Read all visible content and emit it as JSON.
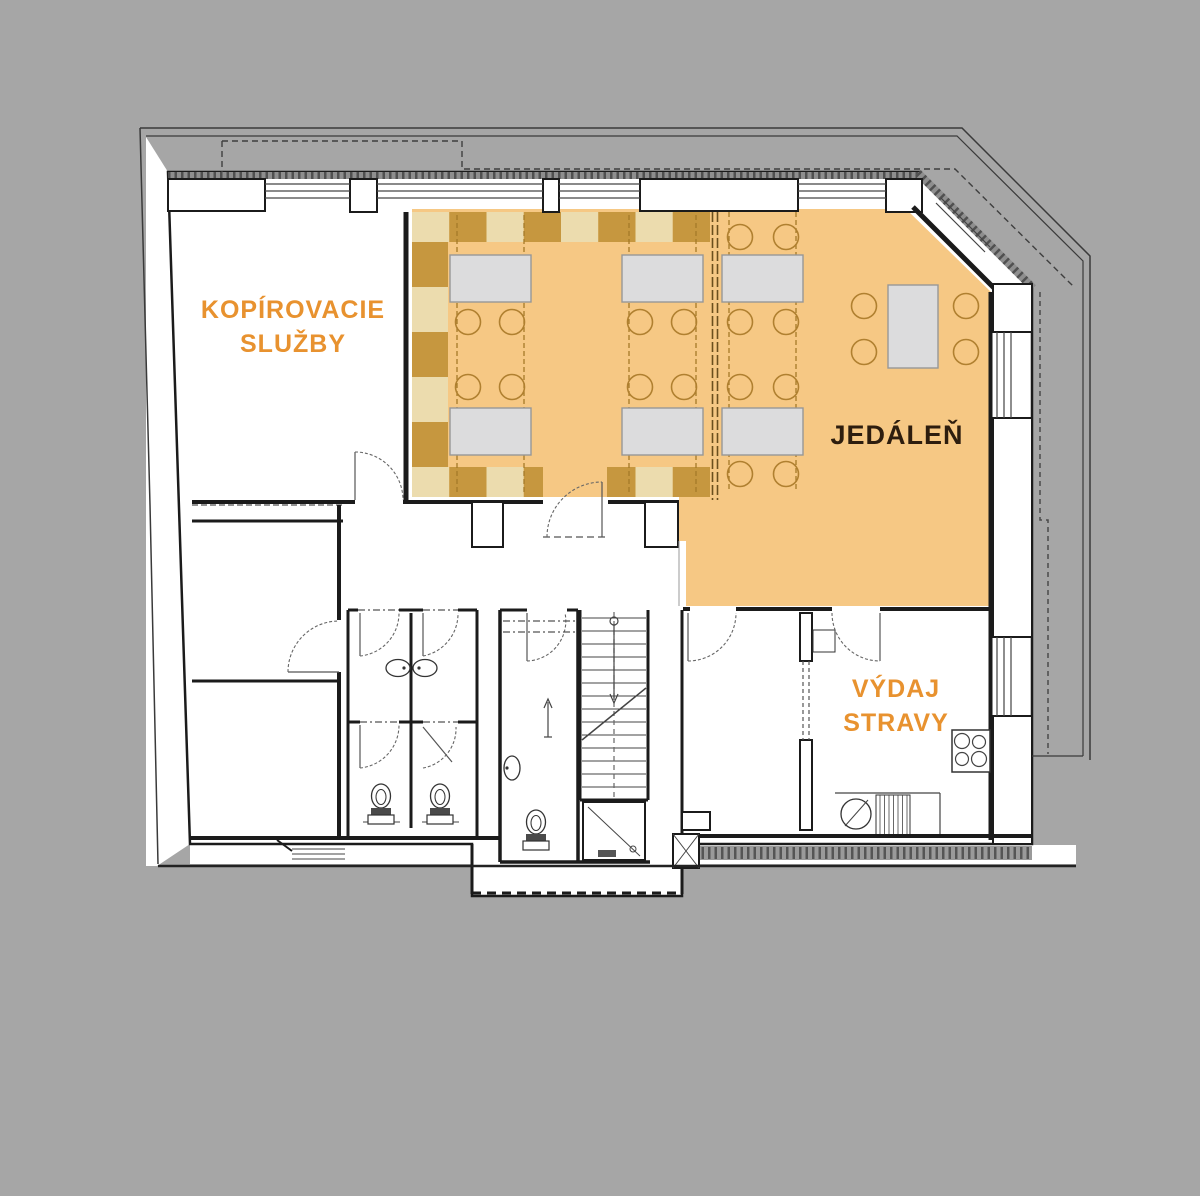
{
  "title": "Floor plan – dining level",
  "colors": {
    "bg": "#a6a6a6",
    "floor_orange": "#f6c884",
    "tile_dark": "#c6973f",
    "tile_light": "#ecdcae",
    "wall": "#1b1b1b",
    "table_gray": "#dcdcdd",
    "chair_outline": "#b08030",
    "label_orange": "#e8922f",
    "label_dark": "#2d1d0e"
  },
  "rooms": {
    "copy_services": {
      "label_line1": "KOPÍROVACIE",
      "label_line2": "SLUŽBY"
    },
    "dining": {
      "label": "JEDÁLEŇ"
    },
    "food_serving": {
      "label_line1": "VÝDAJ",
      "label_line2": "STRAVY"
    }
  },
  "furniture": {
    "dining_tables": 7,
    "dining_chairs": 20,
    "toilets": 3,
    "sinks": 4,
    "cooktop_burners": 4,
    "showers": 1,
    "staircases": 1
  }
}
